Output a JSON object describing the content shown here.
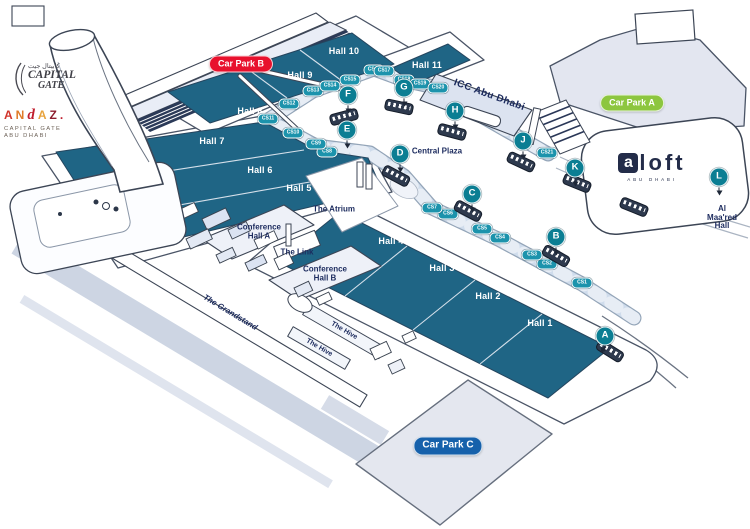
{
  "colors": {
    "hall_fill": "#1f6585",
    "marker": "#0b7e93",
    "suite": "#1c93ac",
    "navy_text": "#1c2b5e",
    "carpark_a": "#8dc63f",
    "carpark_b": "#e8112d",
    "carpark_c": "#1661ab",
    "outline": "#3c4555"
  },
  "logos": {
    "capital_gate": {
      "arabic": "كابيتال جيت",
      "line1": "CAPITAL",
      "line2": "GATE"
    },
    "andaz": {
      "letters": [
        {
          "ch": "A",
          "color": "#d1342b"
        },
        {
          "ch": "N",
          "color": "#e07b28"
        },
        {
          "ch": "d",
          "color": "#c01f2f",
          "script": true
        },
        {
          "ch": "A",
          "color": "#e8a33d"
        },
        {
          "ch": "Z",
          "color": "#8c1d2e"
        },
        {
          "ch": ".",
          "color": "#c01f2f"
        }
      ],
      "sub1": "CAPITAL GATE",
      "sub2": "ABU DHABI"
    },
    "aloft": {
      "badge": "a",
      "rest": "loft",
      "sub": "ABU DHABI"
    }
  },
  "car_parks": [
    {
      "id": "carpark-b",
      "label": "Car Park B",
      "color": "#e8112d",
      "x": 241,
      "y": 64
    },
    {
      "id": "carpark-a",
      "label": "Car Park A",
      "color": "#8dc63f",
      "x": 632,
      "y": 103
    },
    {
      "id": "carpark-c",
      "label": "Car Park C",
      "color": "#1661ab",
      "x": 448,
      "y": 446,
      "big": true
    }
  ],
  "halls": [
    {
      "label": "Hall 1",
      "x": 540,
      "y": 324
    },
    {
      "label": "Hall 2",
      "x": 488,
      "y": 297
    },
    {
      "label": "Hall 3",
      "x": 442,
      "y": 269
    },
    {
      "label": "Hall 4",
      "x": 391,
      "y": 242
    },
    {
      "label": "Hall 5",
      "x": 299,
      "y": 189
    },
    {
      "label": "Hall 6",
      "x": 260,
      "y": 171
    },
    {
      "label": "Hall 7",
      "x": 212,
      "y": 142
    },
    {
      "label": "Hall 8",
      "x": 250,
      "y": 112
    },
    {
      "label": "Hall 9",
      "x": 300,
      "y": 76
    },
    {
      "label": "Hall 10",
      "x": 344,
      "y": 52
    },
    {
      "label": "Hall 11",
      "x": 427,
      "y": 66
    }
  ],
  "places": [
    {
      "label": "Central Plaza",
      "x": 437,
      "y": 152,
      "variant": "area"
    },
    {
      "label": "The Atrium",
      "x": 334,
      "y": 210,
      "variant": "area"
    },
    {
      "label": "The Link",
      "x": 297,
      "y": 253,
      "variant": "area"
    },
    {
      "label": "Conference\nHall A",
      "x": 259,
      "y": 232,
      "variant": "area"
    },
    {
      "label": "Conference\nHall B",
      "x": 325,
      "y": 274,
      "variant": "area"
    },
    {
      "label": "The Grandstand",
      "x": 230,
      "y": 313,
      "rot": 31,
      "variant": "grandstand"
    },
    {
      "label": "The Hive",
      "x": 344,
      "y": 331,
      "rot": 30,
      "variant": "hive"
    },
    {
      "label": "The Hive",
      "x": 319,
      "y": 348,
      "rot": 30,
      "variant": "hive"
    },
    {
      "label": "ICC Abu Dhabi",
      "x": 489,
      "y": 96,
      "rot": 20,
      "variant": "icc"
    },
    {
      "label": "Al Maa'red\nHall",
      "x": 722,
      "y": 218,
      "variant": "area"
    }
  ],
  "entrances": [
    {
      "letter": "A",
      "x": 605,
      "y": 336,
      "dir": "dl"
    },
    {
      "letter": "B",
      "x": 556,
      "y": 237,
      "dir": "d"
    },
    {
      "letter": "C",
      "x": 472,
      "y": 194,
      "dir": "d"
    },
    {
      "letter": "D",
      "x": 400,
      "y": 154,
      "dir": "d"
    },
    {
      "letter": "E",
      "x": 347,
      "y": 130,
      "dir": "d"
    },
    {
      "letter": "F",
      "x": 348,
      "y": 95,
      "dir": "d"
    },
    {
      "letter": "G",
      "x": 404,
      "y": 88,
      "dir": "d"
    },
    {
      "letter": "H",
      "x": 455,
      "y": 111,
      "dir": "d"
    },
    {
      "letter": "J",
      "x": 523,
      "y": 141,
      "dir": "d"
    },
    {
      "letter": "K",
      "x": 575,
      "y": 168,
      "dir": "d"
    },
    {
      "letter": "L",
      "x": 719,
      "y": 177,
      "dir": "d"
    }
  ],
  "suites": [
    {
      "label": "CS1",
      "x": 582,
      "y": 283
    },
    {
      "label": "CS2",
      "x": 547,
      "y": 264
    },
    {
      "label": "CS3",
      "x": 532,
      "y": 255
    },
    {
      "label": "CS4",
      "x": 500,
      "y": 238
    },
    {
      "label": "CS5",
      "x": 482,
      "y": 229
    },
    {
      "label": "CS6",
      "x": 448,
      "y": 214
    },
    {
      "label": "CS7",
      "x": 432,
      "y": 208
    },
    {
      "label": "CS8",
      "x": 327,
      "y": 152
    },
    {
      "label": "CS9",
      "x": 316,
      "y": 144
    },
    {
      "label": "CS10",
      "x": 293,
      "y": 133
    },
    {
      "label": "CS11",
      "x": 268,
      "y": 119
    },
    {
      "label": "CS12",
      "x": 289,
      "y": 104
    },
    {
      "label": "CS13",
      "x": 313,
      "y": 91
    },
    {
      "label": "CS14",
      "x": 330,
      "y": 86
    },
    {
      "label": "CS15",
      "x": 350,
      "y": 80
    },
    {
      "label": "CS16",
      "x": 374,
      "y": 70
    },
    {
      "label": "CS17",
      "x": 384,
      "y": 71
    },
    {
      "label": "CS18",
      "x": 404,
      "y": 80
    },
    {
      "label": "CS19",
      "x": 420,
      "y": 84
    },
    {
      "label": "CS20",
      "x": 438,
      "y": 88
    },
    {
      "label": "CS21",
      "x": 547,
      "y": 153
    }
  ],
  "buses": [
    {
      "x": 610,
      "y": 351,
      "rot": 32
    },
    {
      "x": 556,
      "y": 256,
      "rot": 30
    },
    {
      "x": 468,
      "y": 211,
      "rot": 28
    },
    {
      "x": 396,
      "y": 176,
      "rot": 28
    },
    {
      "x": 344,
      "y": 117,
      "rot": -15
    },
    {
      "x": 399,
      "y": 107,
      "rot": 12
    },
    {
      "x": 452,
      "y": 132,
      "rot": 15
    },
    {
      "x": 521,
      "y": 162,
      "rot": 25
    },
    {
      "x": 577,
      "y": 183,
      "rot": 22
    },
    {
      "x": 634,
      "y": 207,
      "rot": 22
    }
  ]
}
